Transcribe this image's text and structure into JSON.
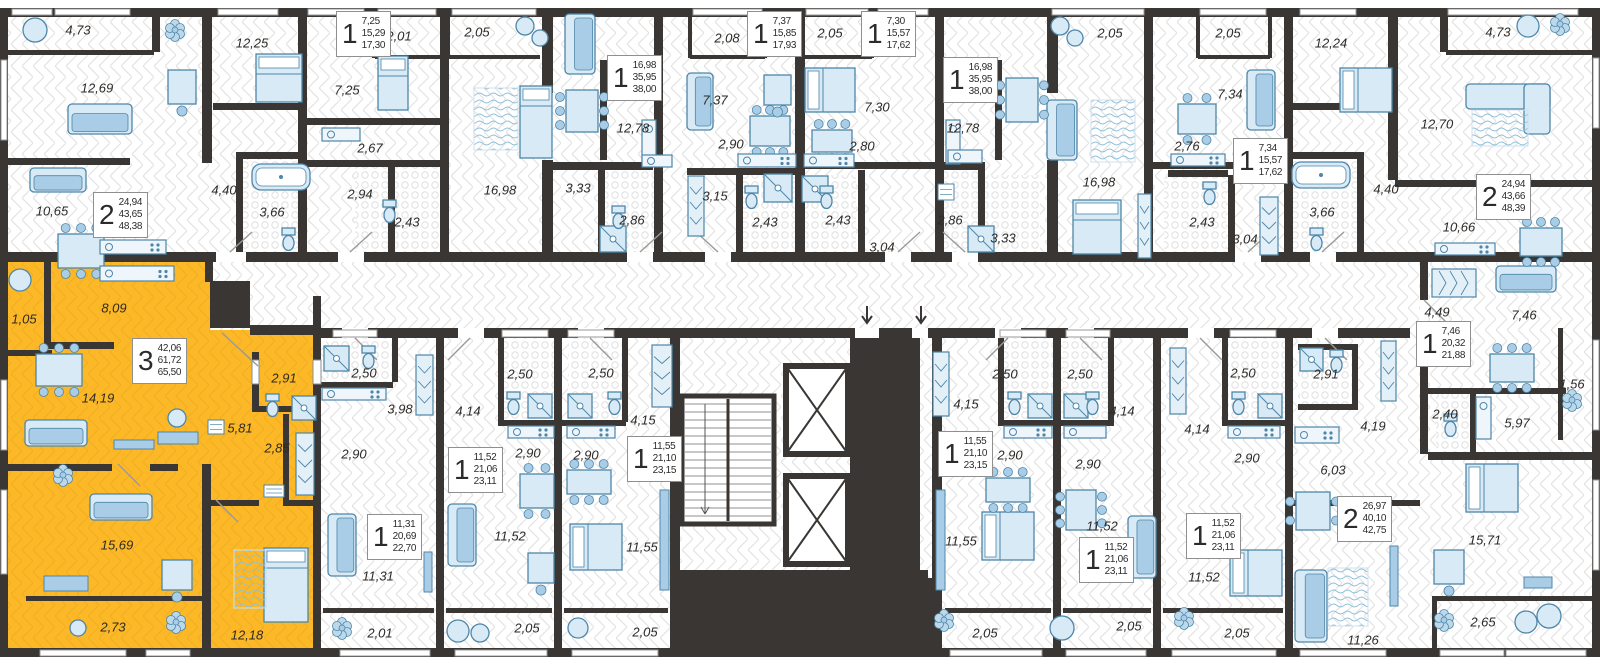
{
  "plan_meta": {
    "type": "residential-floor-plan",
    "highlight_color": "#FCB827",
    "wall_color": "#3A3633",
    "furniture_stroke": "#4E86A8",
    "selected_apartment": {
      "rooms": "3",
      "area_living": "42,06",
      "area_main": "61,72",
      "area_total": "65,50"
    }
  },
  "room_labels": [
    {
      "t": "4,73",
      "x": 78,
      "y": 30,
      "hl": false
    },
    {
      "t": "12,69",
      "x": 97,
      "y": 88,
      "hl": false
    },
    {
      "t": "12,25",
      "x": 252,
      "y": 43,
      "hl": false
    },
    {
      "t": "2,01",
      "x": 399,
      "y": 36,
      "hl": false
    },
    {
      "t": "7,25",
      "x": 347,
      "y": 90,
      "hl": false
    },
    {
      "t": "2,67",
      "x": 370,
      "y": 148,
      "hl": false
    },
    {
      "t": "2,94",
      "x": 360,
      "y": 194,
      "hl": false
    },
    {
      "t": "2,43",
      "x": 407,
      "y": 222,
      "hl": false
    },
    {
      "t": "4,40",
      "x": 224,
      "y": 190,
      "hl": false
    },
    {
      "t": "3,66",
      "x": 272,
      "y": 212,
      "hl": false
    },
    {
      "t": "10,65",
      "x": 52,
      "y": 211,
      "hl": false
    },
    {
      "t": "2,05",
      "x": 477,
      "y": 32,
      "hl": false
    },
    {
      "t": "16,98",
      "x": 500,
      "y": 190,
      "hl": false
    },
    {
      "t": "12,78",
      "x": 633,
      "y": 128,
      "hl": false
    },
    {
      "t": "3,33",
      "x": 578,
      "y": 188,
      "hl": false
    },
    {
      "t": "2,86",
      "x": 632,
      "y": 220,
      "hl": false
    },
    {
      "t": "2,08",
      "x": 727,
      "y": 38,
      "hl": false
    },
    {
      "t": "7,37",
      "x": 715,
      "y": 100,
      "hl": false
    },
    {
      "t": "2,90",
      "x": 731,
      "y": 144,
      "hl": false
    },
    {
      "t": "3,15",
      "x": 715,
      "y": 196,
      "hl": false
    },
    {
      "t": "2,43",
      "x": 765,
      "y": 222,
      "hl": false
    },
    {
      "t": "2,05",
      "x": 830,
      "y": 33,
      "hl": false
    },
    {
      "t": "7,30",
      "x": 877,
      "y": 107,
      "hl": false
    },
    {
      "t": "2,80",
      "x": 862,
      "y": 146,
      "hl": false
    },
    {
      "t": "2,43",
      "x": 838,
      "y": 220,
      "hl": false
    },
    {
      "t": "3,04",
      "x": 882,
      "y": 247,
      "hl": false
    },
    {
      "t": "2,05",
      "x": 1110,
      "y": 33,
      "hl": false
    },
    {
      "t": "12,78",
      "x": 963,
      "y": 128,
      "hl": false
    },
    {
      "t": "16,98",
      "x": 1099,
      "y": 182,
      "hl": false
    },
    {
      "t": "2,86",
      "x": 950,
      "y": 220,
      "hl": false
    },
    {
      "t": "3,33",
      "x": 1003,
      "y": 238,
      "hl": false
    },
    {
      "t": "2,05",
      "x": 1228,
      "y": 33,
      "hl": false
    },
    {
      "t": "7,34",
      "x": 1230,
      "y": 94,
      "hl": false
    },
    {
      "t": "2,76",
      "x": 1187,
      "y": 146,
      "hl": false
    },
    {
      "t": "2,43",
      "x": 1202,
      "y": 222,
      "hl": false
    },
    {
      "t": "3,04",
      "x": 1245,
      "y": 239,
      "hl": false
    },
    {
      "t": "12,24",
      "x": 1331,
      "y": 43,
      "hl": false
    },
    {
      "t": "4,73",
      "x": 1498,
      "y": 32,
      "hl": false
    },
    {
      "t": "12,70",
      "x": 1437,
      "y": 124,
      "hl": false
    },
    {
      "t": "4,40",
      "x": 1386,
      "y": 189,
      "hl": false
    },
    {
      "t": "3,66",
      "x": 1322,
      "y": 212,
      "hl": false
    },
    {
      "t": "10,66",
      "x": 1459,
      "y": 227,
      "hl": false
    },
    {
      "t": "1,05",
      "x": 24,
      "y": 319,
      "hl": true
    },
    {
      "t": "8,09",
      "x": 114,
      "y": 308,
      "hl": true
    },
    {
      "t": "14,19",
      "x": 98,
      "y": 398,
      "hl": true
    },
    {
      "t": "2,91",
      "x": 284,
      "y": 378,
      "hl": true
    },
    {
      "t": "5,81",
      "x": 240,
      "y": 428,
      "hl": true
    },
    {
      "t": "2,85",
      "x": 277,
      "y": 448,
      "hl": true
    },
    {
      "t": "15,69",
      "x": 117,
      "y": 545,
      "hl": true
    },
    {
      "t": "2,73",
      "x": 113,
      "y": 627,
      "hl": true
    },
    {
      "t": "12,18",
      "x": 247,
      "y": 635,
      "hl": true
    },
    {
      "t": "2,50",
      "x": 364,
      "y": 373,
      "hl": false
    },
    {
      "t": "3,98",
      "x": 400,
      "y": 409,
      "hl": false
    },
    {
      "t": "2,90",
      "x": 354,
      "y": 454,
      "hl": false
    },
    {
      "t": "11,31",
      "x": 378,
      "y": 576,
      "hl": false
    },
    {
      "t": "2,01",
      "x": 380,
      "y": 633,
      "hl": false
    },
    {
      "t": "2,50",
      "x": 520,
      "y": 374,
      "hl": false
    },
    {
      "t": "4,14",
      "x": 468,
      "y": 411,
      "hl": false
    },
    {
      "t": "2,90",
      "x": 528,
      "y": 453,
      "hl": false
    },
    {
      "t": "11,52",
      "x": 510,
      "y": 536,
      "hl": false
    },
    {
      "t": "2,05",
      "x": 527,
      "y": 628,
      "hl": false
    },
    {
      "t": "2,50",
      "x": 601,
      "y": 373,
      "hl": false
    },
    {
      "t": "4,15",
      "x": 643,
      "y": 420,
      "hl": false
    },
    {
      "t": "2,90",
      "x": 586,
      "y": 455,
      "hl": false
    },
    {
      "t": "11,55",
      "x": 642,
      "y": 547,
      "hl": false
    },
    {
      "t": "2,05",
      "x": 645,
      "y": 632,
      "hl": false
    },
    {
      "t": "2,50",
      "x": 1005,
      "y": 374,
      "hl": false
    },
    {
      "t": "4,15",
      "x": 966,
      "y": 404,
      "hl": false
    },
    {
      "t": "2,90",
      "x": 1010,
      "y": 455,
      "hl": false
    },
    {
      "t": "11,55",
      "x": 961,
      "y": 541,
      "hl": false
    },
    {
      "t": "2,05",
      "x": 985,
      "y": 633,
      "hl": false
    },
    {
      "t": "2,50",
      "x": 1080,
      "y": 374,
      "hl": false
    },
    {
      "t": "4,14",
      "x": 1122,
      "y": 411,
      "hl": false
    },
    {
      "t": "2,90",
      "x": 1088,
      "y": 464,
      "hl": false
    },
    {
      "t": "11,52",
      "x": 1102,
      "y": 526,
      "hl": false
    },
    {
      "t": "2,05",
      "x": 1129,
      "y": 626,
      "hl": false
    },
    {
      "t": "2,50",
      "x": 1243,
      "y": 373,
      "hl": false
    },
    {
      "t": "4,14",
      "x": 1197,
      "y": 429,
      "hl": false
    },
    {
      "t": "2,90",
      "x": 1247,
      "y": 458,
      "hl": false
    },
    {
      "t": "11,52",
      "x": 1204,
      "y": 577,
      "hl": false
    },
    {
      "t": "2,05",
      "x": 1237,
      "y": 633,
      "hl": false
    },
    {
      "t": "2,91",
      "x": 1326,
      "y": 374,
      "hl": false
    },
    {
      "t": "4,19",
      "x": 1373,
      "y": 426,
      "hl": false
    },
    {
      "t": "6,03",
      "x": 1333,
      "y": 470,
      "hl": false
    },
    {
      "t": "11,26",
      "x": 1363,
      "y": 640,
      "hl": false
    },
    {
      "t": "15,71",
      "x": 1485,
      "y": 540,
      "hl": false
    },
    {
      "t": "2,65",
      "x": 1483,
      "y": 622,
      "hl": false
    },
    {
      "t": "4,49",
      "x": 1437,
      "y": 312,
      "hl": false
    },
    {
      "t": "7,46",
      "x": 1524,
      "y": 315,
      "hl": false
    },
    {
      "t": "2,40",
      "x": 1445,
      "y": 414,
      "hl": false
    },
    {
      "t": "5,97",
      "x": 1517,
      "y": 423,
      "hl": false
    },
    {
      "t": "1,56",
      "x": 1572,
      "y": 384,
      "hl": false
    }
  ],
  "apartments": [
    {
      "rooms": "2",
      "areas": [
        "24,94",
        "43,65",
        "48,38"
      ],
      "x": 93,
      "y": 192,
      "hl": false
    },
    {
      "rooms": "1",
      "areas": [
        "7,25",
        "15,29",
        "17,30"
      ],
      "x": 336,
      "y": 11,
      "hl": false
    },
    {
      "rooms": "1",
      "areas": [
        "16,98",
        "35,95",
        "38,00"
      ],
      "x": 607,
      "y": 55,
      "hl": false
    },
    {
      "rooms": "1",
      "areas": [
        "7,37",
        "15,85",
        "17,93"
      ],
      "x": 747,
      "y": 11,
      "hl": false
    },
    {
      "rooms": "1",
      "areas": [
        "7,30",
        "15,57",
        "17,62"
      ],
      "x": 861,
      "y": 11,
      "hl": false
    },
    {
      "rooms": "1",
      "areas": [
        "16,98",
        "35,95",
        "38,00"
      ],
      "x": 943,
      "y": 57,
      "hl": false
    },
    {
      "rooms": "1",
      "areas": [
        "7,34",
        "15,57",
        "17,62"
      ],
      "x": 1233,
      "y": 138,
      "hl": false
    },
    {
      "rooms": "2",
      "areas": [
        "24,94",
        "43,66",
        "48,39"
      ],
      "x": 1476,
      "y": 174,
      "hl": false
    },
    {
      "rooms": "3",
      "areas": [
        "42,06",
        "61,72",
        "65,50"
      ],
      "x": 132,
      "y": 338,
      "hl": true
    },
    {
      "rooms": "1",
      "areas": [
        "11,31",
        "20,69",
        "22,70"
      ],
      "x": 367,
      "y": 514,
      "hl": false
    },
    {
      "rooms": "1",
      "areas": [
        "11,52",
        "21,06",
        "23,11"
      ],
      "x": 448,
      "y": 447,
      "hl": false
    },
    {
      "rooms": "1",
      "areas": [
        "11,55",
        "21,10",
        "23,15"
      ],
      "x": 627,
      "y": 436,
      "hl": false
    },
    {
      "rooms": "1",
      "areas": [
        "11,55",
        "21,10",
        "23,15"
      ],
      "x": 938,
      "y": 431,
      "hl": false
    },
    {
      "rooms": "1",
      "areas": [
        "11,52",
        "21,06",
        "23,11"
      ],
      "x": 1079,
      "y": 537,
      "hl": false
    },
    {
      "rooms": "1",
      "areas": [
        "11,52",
        "21,06",
        "23,11"
      ],
      "x": 1186,
      "y": 513,
      "hl": false
    },
    {
      "rooms": "2",
      "areas": [
        "26,97",
        "40,10",
        "42,75"
      ],
      "x": 1337,
      "y": 496,
      "hl": false
    },
    {
      "rooms": "1",
      "areas": [
        "7,46",
        "20,32",
        "21,88"
      ],
      "x": 1416,
      "y": 321,
      "hl": false
    }
  ]
}
